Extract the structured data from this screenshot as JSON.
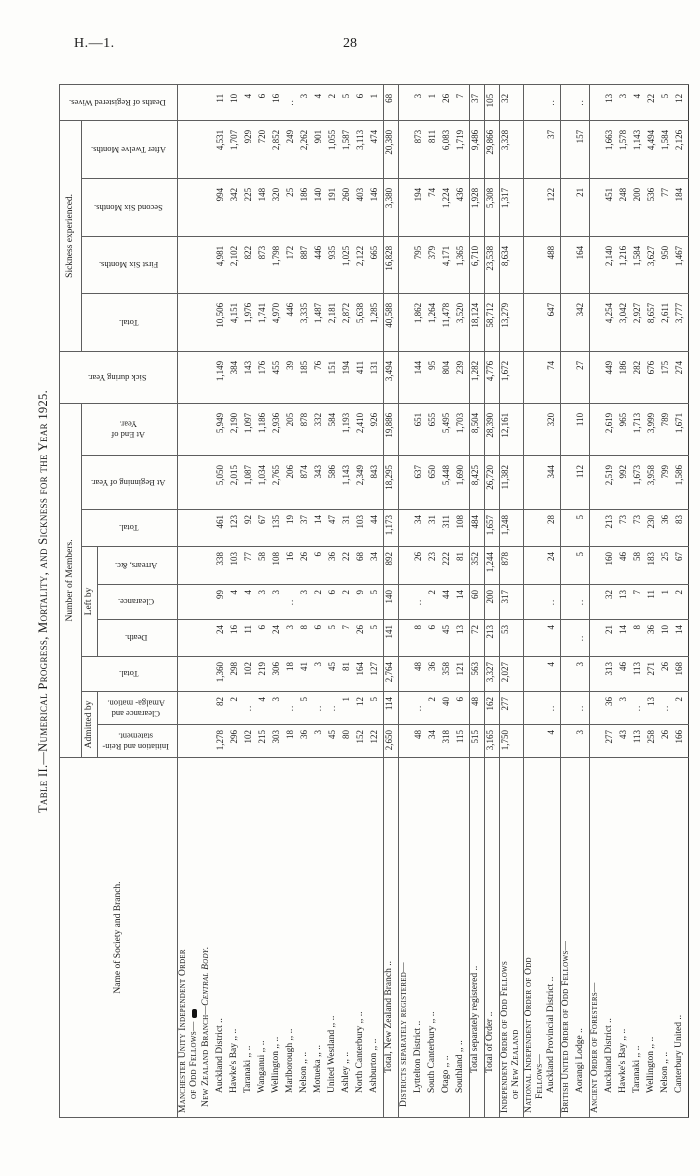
{
  "page": {
    "doc_ref": "H.—1.",
    "page_number": "28"
  },
  "title": "Table II.—Numerical Progress, Mortality, and Sickness for the Year 1925.",
  "table": {
    "header": {
      "name": "Name of Society and Branch.",
      "members_group": "Number of Members.",
      "admitted_group": "Admitted by",
      "left_group": "Left by",
      "sickness_group": "Sickness experienced.",
      "sick_during": "Sick during Year.",
      "deaths_wives": "Deaths of Registered Wives.",
      "total": "Total.",
      "initiation": "Initiation and Rein-statement.",
      "clearance_amalg": "Clearance and Amalga- mation.",
      "death": "Death.",
      "clearance": "Clearance.",
      "arrears": "Arrears, &c.",
      "at_beginning": "At Beginning of Year.",
      "at_end": "At End of Year.",
      "first_six": "First Six Months.",
      "second_six": "Second Six Months.",
      "after_twelve": "After Twelve Months."
    },
    "column_keys": [
      "initiation",
      "clearance_amalg",
      "total_admitted",
      "death",
      "clearance",
      "arrears",
      "total_left",
      "at_beginning",
      "at_end",
      "sick_during",
      "total_sickness",
      "first_six",
      "second_six",
      "after_twelve",
      "deaths_wives"
    ],
    "rows": [
      {
        "label": "Manchester Unity Independent Order",
        "label2": "of Odd Fellows—",
        "style": "sc",
        "blob": true
      },
      {
        "label": "New Zealand Branch",
        "suffix": "—Central Body.",
        "style": "sc",
        "indent": 1
      },
      {
        "label": "Auckland District ..",
        "indent": 2,
        "values": [
          "1,278",
          "82",
          "1,360",
          "24",
          "99",
          "338",
          "461",
          "5,050",
          "5,949",
          "1,149",
          "10,506",
          "4,981",
          "994",
          "4,531",
          "11"
        ]
      },
      {
        "label": "Hawke's Bay ,, ..",
        "indent": 2,
        "values": [
          "296",
          "2",
          "298",
          "16",
          "4",
          "103",
          "123",
          "2,015",
          "2,190",
          "384",
          "4,151",
          "2,102",
          "342",
          "1,707",
          "10"
        ]
      },
      {
        "label": "Taranaki ,, ..",
        "indent": 2,
        "values": [
          "102",
          null,
          "102",
          "11",
          "4",
          "77",
          "92",
          "1,087",
          "1,097",
          "143",
          "1,976",
          "822",
          "225",
          "929",
          "4"
        ]
      },
      {
        "label": "Wanganui ,, ..",
        "indent": 2,
        "values": [
          "215",
          "4",
          "219",
          "6",
          "3",
          "58",
          "67",
          "1,034",
          "1,186",
          "176",
          "1,741",
          "873",
          "148",
          "720",
          "6"
        ]
      },
      {
        "label": "Wellington ,, ..",
        "indent": 2,
        "values": [
          "303",
          "3",
          "306",
          "24",
          "3",
          "108",
          "135",
          "2,765",
          "2,936",
          "455",
          "4,970",
          "1,798",
          "320",
          "2,852",
          "16"
        ]
      },
      {
        "label": "Marlborough ,, ..",
        "indent": 2,
        "values": [
          "18",
          null,
          "18",
          "3",
          null,
          "16",
          "19",
          "206",
          "205",
          "39",
          "446",
          "172",
          "25",
          "249",
          null
        ]
      },
      {
        "label": "Nelson ,, ..",
        "indent": 2,
        "values": [
          "36",
          "5",
          "41",
          "8",
          "3",
          "26",
          "37",
          "874",
          "878",
          "185",
          "3,335",
          "887",
          "186",
          "2,262",
          "3"
        ]
      },
      {
        "label": "Motueka ,, ..",
        "indent": 2,
        "values": [
          "3",
          null,
          "3",
          "6",
          "2",
          "6",
          "14",
          "343",
          "332",
          "76",
          "1,487",
          "446",
          "140",
          "901",
          "4"
        ]
      },
      {
        "label": "United Westland ,, ..",
        "indent": 2,
        "values": [
          "45",
          null,
          "45",
          "5",
          "6",
          "36",
          "47",
          "586",
          "584",
          "151",
          "2,181",
          "935",
          "191",
          "1,055",
          "2"
        ]
      },
      {
        "label": "Ashley ,, ..",
        "indent": 2,
        "values": [
          "80",
          "1",
          "81",
          "7",
          "2",
          "22",
          "31",
          "1,143",
          "1,193",
          "194",
          "2,872",
          "1,025",
          "260",
          "1,587",
          "5"
        ]
      },
      {
        "label": "North Canterbury ,, ..",
        "indent": 2,
        "values": [
          "152",
          "12",
          "164",
          "26",
          "9",
          "68",
          "103",
          "2,349",
          "2,410",
          "411",
          "5,638",
          "2,122",
          "403",
          "3,113",
          "6"
        ]
      },
      {
        "label": "Ashburton ,, ..",
        "indent": 2,
        "values": [
          "122",
          "5",
          "127",
          "5",
          "5",
          "34",
          "44",
          "843",
          "926",
          "131",
          "1,285",
          "665",
          "146",
          "474",
          "1"
        ]
      },
      {
        "label": "Total, New Zealand Branch ..",
        "indent": 3,
        "group": true,
        "values": [
          "2,650",
          "114",
          "2,764",
          "141",
          "140",
          "892",
          "1,173",
          "18,295",
          "19,886",
          "3,494",
          "40,588",
          "16,828",
          "3,380",
          "20,380",
          "68"
        ]
      },
      {
        "label": "Districts separately registered—",
        "style": "sc",
        "indent": 1,
        "group": true
      },
      {
        "label": "Lyttelton District ..",
        "indent": 2,
        "values": [
          "48",
          null,
          "48",
          "8",
          null,
          "26",
          "34",
          "637",
          "651",
          "144",
          "1,862",
          "795",
          "194",
          "873",
          "3"
        ]
      },
      {
        "label": "South Canterbury ,, ..",
        "indent": 2,
        "values": [
          "34",
          "2",
          "36",
          "6",
          "2",
          "23",
          "31",
          "650",
          "655",
          "95",
          "1,264",
          "379",
          "74",
          "811",
          "1"
        ]
      },
      {
        "label": "Otago ,, ..",
        "indent": 2,
        "values": [
          "318",
          "40",
          "358",
          "45",
          "44",
          "222",
          "311",
          "5,448",
          "5,495",
          "804",
          "11,478",
          "4,171",
          "1,224",
          "6,083",
          "26"
        ]
      },
      {
        "label": "Southland ,, ..",
        "indent": 2,
        "values": [
          "115",
          "6",
          "121",
          "13",
          "14",
          "81",
          "108",
          "1,690",
          "1,703",
          "239",
          "3,520",
          "1,365",
          "436",
          "1,719",
          "7"
        ]
      },
      {
        "label": "Total separately registered ..",
        "indent": 3,
        "group": true,
        "values": [
          "515",
          "48",
          "563",
          "72",
          "60",
          "352",
          "484",
          "8,425",
          "8,504",
          "1,282",
          "18,124",
          "6,710",
          "1,928",
          "9,486",
          "37"
        ]
      },
      {
        "label": "Total of Order ..",
        "indent": 3,
        "group": true,
        "values": [
          "3,165",
          "162",
          "3,327",
          "213",
          "200",
          "1,244",
          "1,657",
          "26,720",
          "28,390",
          "4,776",
          "58,712",
          "23,538",
          "5,308",
          "29,866",
          "105"
        ]
      },
      {
        "label": "Independent Order of Odd Fellows",
        "label2": "of New Zealand",
        "style": "sc",
        "group": true,
        "values": [
          "1,750",
          "277",
          "2,027",
          "53",
          "317",
          "878",
          "1,248",
          "11,382",
          "12,161",
          "1,672",
          "13,279",
          "8,634",
          "1,317",
          "3,328",
          "32"
        ]
      },
      {
        "label": "National Independent Order of Odd",
        "label2": "Fellows—",
        "style": "sc",
        "group": true
      },
      {
        "label": "Auckland Provincial District ..",
        "indent": 2,
        "values": [
          "4",
          null,
          "4",
          "4",
          null,
          "24",
          "28",
          "344",
          "320",
          "74",
          "647",
          "488",
          "122",
          "37",
          null
        ]
      },
      {
        "label": "British United Order of Odd Fellows—",
        "style": "sc",
        "group": true
      },
      {
        "label": "Aorangi Lodge ..",
        "indent": 2,
        "values": [
          "3",
          null,
          "3",
          null,
          null,
          "5",
          "5",
          "112",
          "110",
          "27",
          "342",
          "164",
          "21",
          "157",
          null
        ]
      },
      {
        "label": "Ancient Order of Foresters—",
        "style": "sc",
        "group": true
      },
      {
        "label": "Auckland District ..",
        "indent": 2,
        "values": [
          "277",
          "36",
          "313",
          "21",
          "32",
          "160",
          "213",
          "2,519",
          "2,619",
          "449",
          "4,254",
          "2,140",
          "451",
          "1,663",
          "13"
        ]
      },
      {
        "label": "Hawke's Bay ,, ..",
        "indent": 2,
        "values": [
          "43",
          "3",
          "46",
          "14",
          "13",
          "46",
          "73",
          "992",
          "965",
          "186",
          "3,042",
          "1,216",
          "248",
          "1,578",
          "3"
        ]
      },
      {
        "label": "Taranaki ,, ..",
        "indent": 2,
        "values": [
          "113",
          null,
          "113",
          "8",
          "7",
          "58",
          "73",
          "1,673",
          "1,713",
          "282",
          "2,927",
          "1,584",
          "200",
          "1,143",
          "4"
        ]
      },
      {
        "label": "Wellington ,, ..",
        "indent": 2,
        "values": [
          "258",
          "13",
          "271",
          "36",
          "11",
          "183",
          "230",
          "3,958",
          "3,999",
          "676",
          "8,657",
          "3,627",
          "536",
          "4,494",
          "22"
        ]
      },
      {
        "label": "Nelson ,, ..",
        "indent": 2,
        "values": [
          "26",
          null,
          "26",
          "10",
          "1",
          "25",
          "36",
          "799",
          "789",
          "175",
          "2,611",
          "950",
          "77",
          "1,584",
          "5"
        ]
      },
      {
        "label": "Canterbury United ..",
        "indent": 2,
        "values": [
          "166",
          "2",
          "168",
          "14",
          "2",
          "67",
          "83",
          "1,586",
          "1,671",
          "274",
          "3,777",
          "1,467",
          "184",
          "2,126",
          "12"
        ]
      }
    ],
    "nil_mark": ".."
  }
}
